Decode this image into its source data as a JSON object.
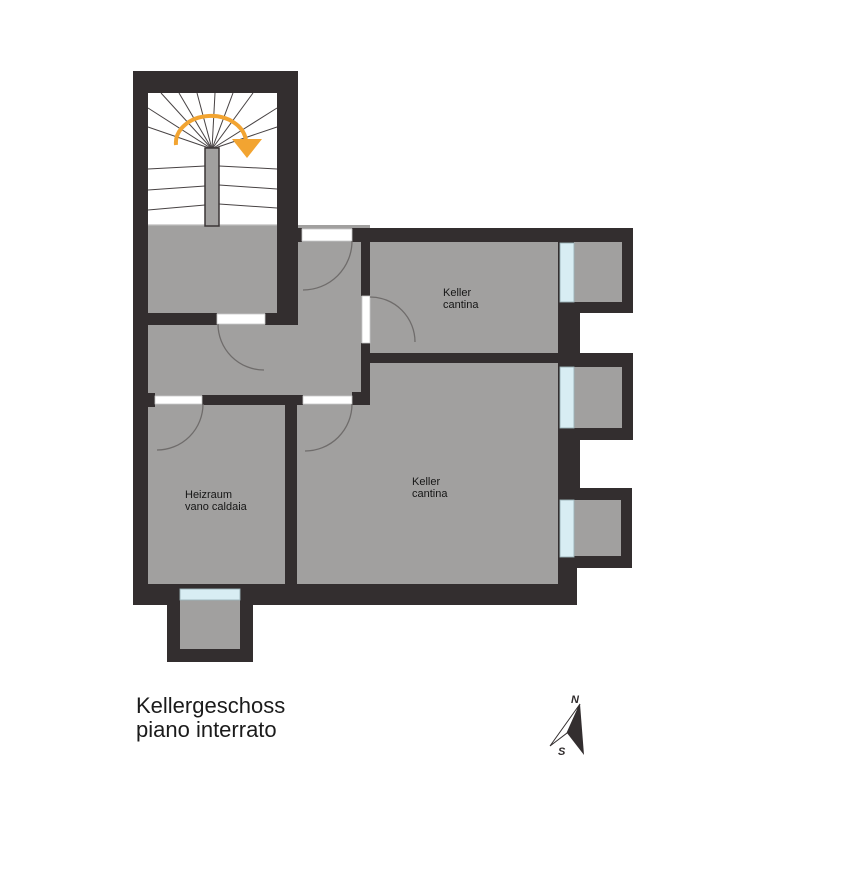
{
  "plan": {
    "title_line1": "Kellergeschoss",
    "title_line2": "piano interrato"
  },
  "rooms": {
    "keller_top": {
      "label_line1": "Keller",
      "label_line2": "cantina"
    },
    "keller_main": {
      "label_line1": "Keller",
      "label_line2": "cantina"
    },
    "heizraum": {
      "label_line1": "Heizraum",
      "label_line2": "vano caldaia"
    }
  },
  "compass": {
    "north_label": "N",
    "south_label": "S"
  },
  "icons": {
    "stair_direction_arrow": "curved-arrow-clockwise-down",
    "north_arrow": "compass-needle"
  },
  "colors": {
    "wall": "#332e2f",
    "floor": "#a1a09f",
    "window": "#d8edf3",
    "door": "#ffffff",
    "stair_area": "#ffffff",
    "accent": "#f2a431",
    "text": "#1a1a1a",
    "background": "#ffffff"
  }
}
